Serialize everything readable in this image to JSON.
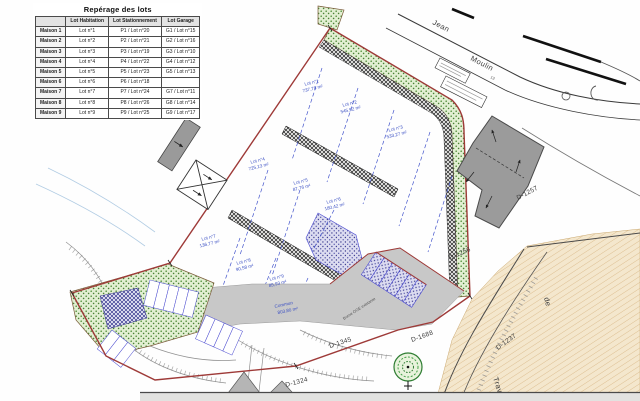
{
  "table": {
    "title": "Repérage des lots",
    "headers": {
      "maison": "",
      "habitation": "Lot Habitation",
      "stationnement": "Lot Stationnement",
      "garage": "Lot Garage"
    },
    "rows": [
      {
        "maison": "Maison 1",
        "habitation": "Lot n°1",
        "stationnement": "P1 / Lot n°20",
        "garage": "G1 / Lot n°15"
      },
      {
        "maison": "Maison 2",
        "habitation": "Lot n°2",
        "stationnement": "P2 / Lot n°21",
        "garage": "G2 / Lot n°16"
      },
      {
        "maison": "Maison 3",
        "habitation": "Lot n°3",
        "stationnement": "P3 / Lot n°19",
        "garage": "G3 / Lot n°10"
      },
      {
        "maison": "Maison 4",
        "habitation": "Lot n°4",
        "stationnement": "P4 / Lot n°22",
        "garage": "G4 / Lot n°12"
      },
      {
        "maison": "Maison 5",
        "habitation": "Lot n°5",
        "stationnement": "P5 / Lot n°23",
        "garage": "G5 / Lot n°13"
      },
      {
        "maison": "Maison 6",
        "habitation": "Lot n°6",
        "stationnement": "P6 / Lot n°18",
        "garage": ""
      },
      {
        "maison": "Maison 7",
        "habitation": "Lot n°7",
        "stationnement": "P7 / Lot n°24",
        "garage": "G7 / Lot n°11"
      },
      {
        "maison": "Maison 8",
        "habitation": "Lot n°8",
        "stationnement": "P8 / Lot n°26",
        "garage": "G8 / Lot n°14"
      },
      {
        "maison": "Maison 9",
        "habitation": "Lot n°9",
        "stationnement": "P9 / Lot n°25",
        "garage": "G9 / Lot n°17"
      }
    ]
  },
  "plan": {
    "streets": {
      "jean": "Jean",
      "moulin": "Moulin",
      "traverse": "Traverse",
      "de": "de",
      "number": "13"
    },
    "parcels": {
      "d1257": "D-1257",
      "d1256": "D-1256",
      "d1237": "D-1237",
      "d1688": "D-1688",
      "d1345": "D-1345",
      "d1324": "D-1324"
    },
    "lots": [
      {
        "name": "Lot n°1",
        "area": "737,78 m²"
      },
      {
        "name": "Lot n°2",
        "area": "545,92 m²"
      },
      {
        "name": "Lot n°3",
        "area": "533,27 m²"
      },
      {
        "name": "Lot n°4",
        "area": "725,13 m²"
      },
      {
        "name": "Lot n°5",
        "area": "87,76 m²"
      },
      {
        "name": "Lot n°6",
        "area": "180,42 m²"
      },
      {
        "name": "Lot n°7",
        "area": "136,77 m²"
      },
      {
        "name": "Lot n°8",
        "area": "90,58 m²"
      },
      {
        "name": "Lot n°9",
        "area": "85,93 m²"
      }
    ],
    "common": {
      "name": "Commun",
      "area": "803,80 m²"
    },
    "notes": {
      "borne": "Borne OGE existante"
    }
  },
  "colors": {
    "boundary_red": "#9e3a38",
    "lot_label_blue": "#3a4fc4",
    "green_buffer": "#5a9641",
    "existing_road_tan": "#f4e7cd",
    "building_gray": "#9b9b9b"
  }
}
